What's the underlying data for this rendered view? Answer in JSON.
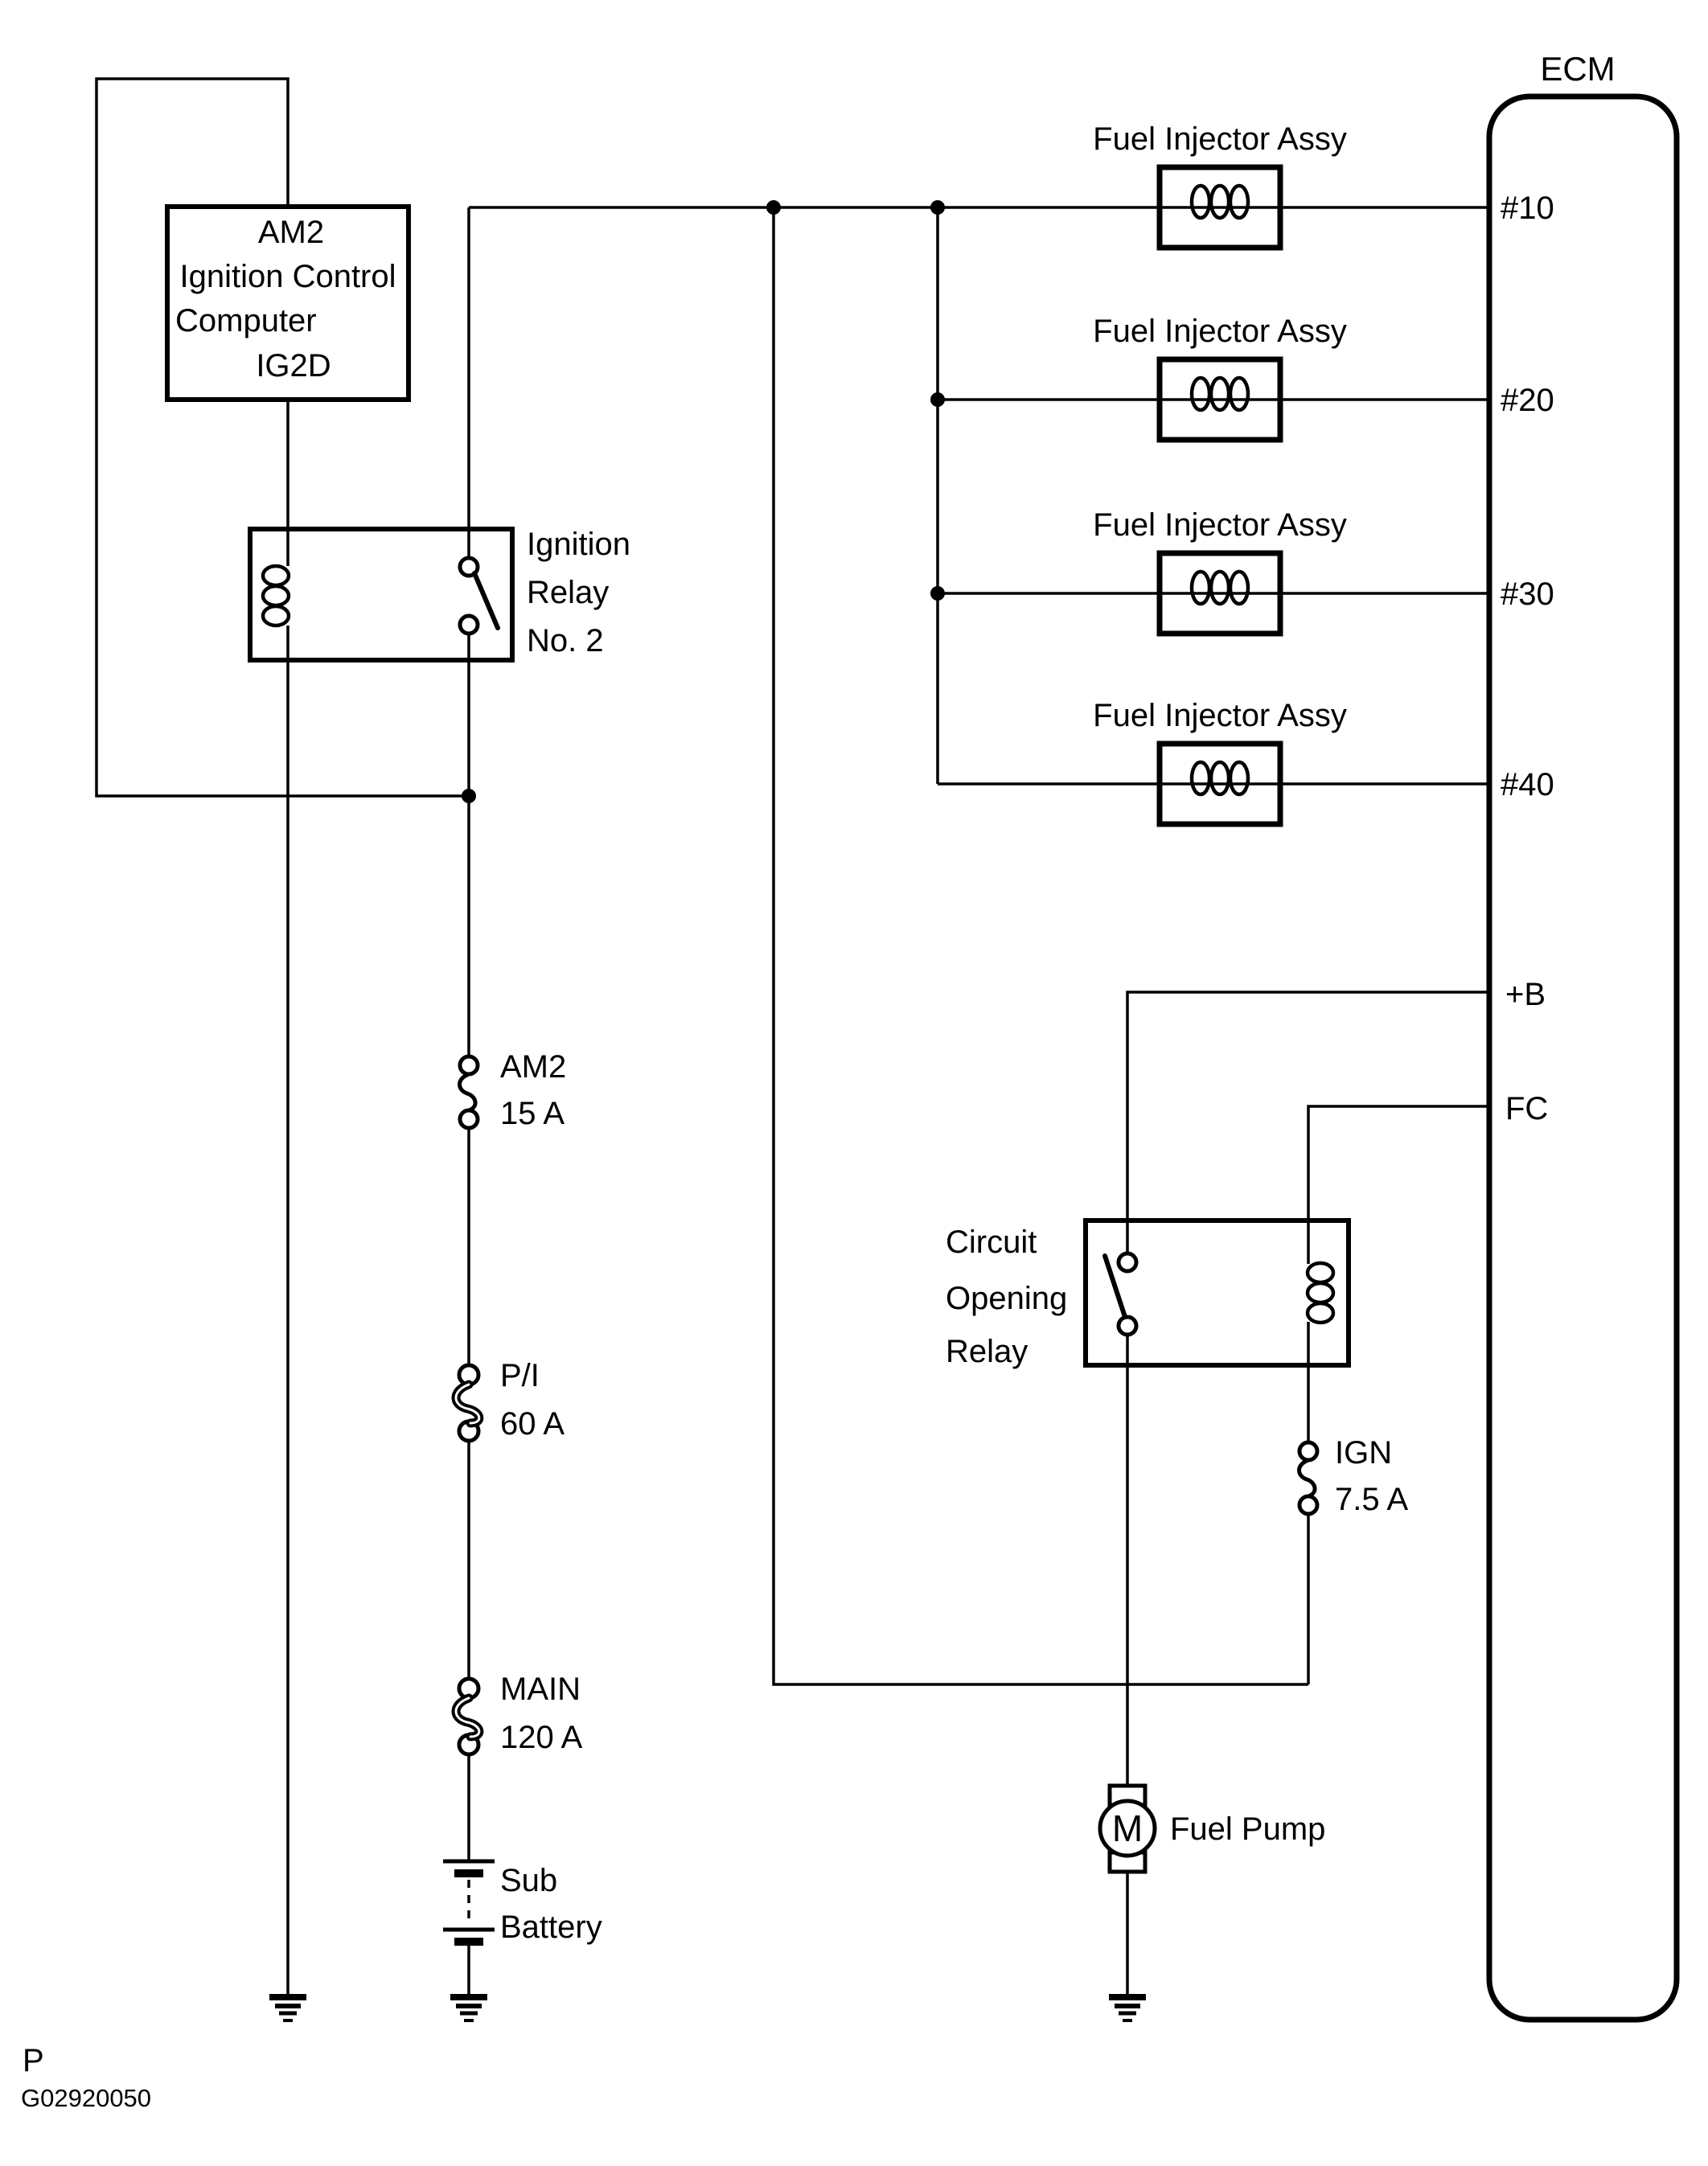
{
  "diagram_title": "Fuel injector / fuel pump wiring diagram",
  "ecm": {
    "title": "ECM",
    "pins": [
      {
        "label": "#10"
      },
      {
        "label": "#20"
      },
      {
        "label": "#30"
      },
      {
        "label": "#40"
      },
      {
        "label": "+B"
      },
      {
        "label": "FC"
      }
    ]
  },
  "ignition_computer": {
    "line1": "AM2",
    "line2": "Ignition Control",
    "line3": "Computer",
    "line4": "IG2D"
  },
  "ignition_relay": {
    "line1": "Ignition",
    "line2": "Relay",
    "line3": "No. 2"
  },
  "injector_label": "Fuel Injector Assy",
  "fuses": {
    "am2": {
      "name": "AM2",
      "rating": "15 A"
    },
    "pi": {
      "name": "P/I",
      "rating": "60 A"
    },
    "main": {
      "name": "MAIN",
      "rating": "120 A"
    },
    "ign": {
      "name": "IGN",
      "rating": "7.5 A"
    }
  },
  "battery": {
    "line1": "Sub",
    "line2": "Battery"
  },
  "circuit_opening_relay": {
    "line1": "Circuit",
    "line2": "Opening",
    "line3": "Relay"
  },
  "fuel_pump": {
    "label": "Fuel Pump",
    "motor": "M"
  },
  "footer": {
    "page": "P",
    "code": "G02920050"
  },
  "colors": {
    "line": "#000000",
    "background": "#ffffff"
  }
}
